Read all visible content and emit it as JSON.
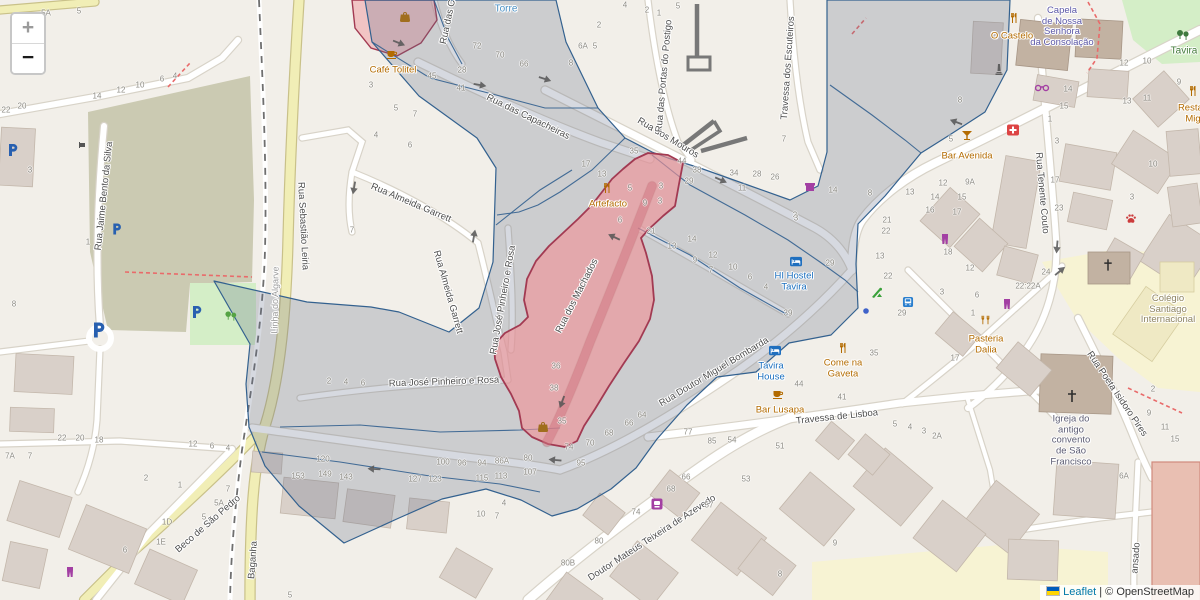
{
  "attribution": {
    "leaflet": "Leaflet",
    "separator": " | ",
    "osm": "© OpenStreetMap"
  },
  "controls": {
    "zoom_in": "+",
    "zoom_out": "−"
  },
  "colors": {
    "bg": "#f2efe9",
    "road": "#ffffff",
    "road_casing": "#d8d3c8",
    "yellow_road": "#f1eeb6",
    "yellow_casing": "#c9c189",
    "olive": "#cbcab2",
    "park": "#d4eec7",
    "school": "#f7f3d3",
    "building": "#d9d0c9",
    "building_stroke": "#c3b7ab",
    "building_dark": "#c2b2a2",
    "salmon": "#e9bfb2",
    "salmon_stroke": "#d08a7c",
    "overlay_stroke": "#33618f",
    "overlay_fill": "rgba(96,110,134,0.26)",
    "selected_stroke": "#a23a52",
    "selected_fill": "rgba(240,145,150,0.62)",
    "selected_road": "rgba(205,115,125,0.55)",
    "red_dash": "#e96a6a",
    "street_label": "#4e4e4e",
    "number": "#8f8d86",
    "poi_orange": "#b36b00",
    "poi_blue": "#1a6fbf",
    "poi_purple": "#5b57a7",
    "rail_dash": "#6f6f6f",
    "wall": "#787878",
    "attr_link": "#0078a8",
    "attr_text": "#333333"
  },
  "icon_colors": {
    "cafe": "#b36b00",
    "restaurant": "#b36b00",
    "restaurant2": "#b36b00",
    "bar": "#b36b00",
    "bag": "#a06e1e",
    "hostel": "#1f6fbf",
    "store": "#a33fa3",
    "clothes": "#a33fa3",
    "shop": "#a33fa3",
    "glasses": "#a33fa3",
    "busstop": "#2a7fce",
    "dot": "#3f62c9",
    "playground": "#3aa13a",
    "parking": "#2860b0",
    "firstaid": "#dd4444",
    "paw": "#cc3b3b",
    "worship": "#2d2d2d",
    "trees": "#3f7a3f",
    "trees2": "#55a344",
    "monument": "#606060",
    "barrier": "#555555"
  },
  "streets": [
    {
      "t": "Rua Jaime Bento da Silva",
      "x": 104,
      "y": 196,
      "r": -84
    },
    {
      "t": "Rua Sebastião Leiria",
      "x": 303,
      "y": 226,
      "r": 87
    },
    {
      "t": "Linha do Algarve",
      "x": 275,
      "y": 300,
      "r": -89,
      "c": "rail"
    },
    {
      "t": "Rua Almeida Garrett",
      "x": 411,
      "y": 203,
      "r": 23
    },
    {
      "t": "Rua Almeida Garrett",
      "x": 448,
      "y": 292,
      "r": 74
    },
    {
      "t": "Rua José Pinheiro e Rosa",
      "x": 503,
      "y": 300,
      "r": -80
    },
    {
      "t": "Rua José Pinheiro e Rosa",
      "x": 444,
      "y": 382,
      "r": -2
    },
    {
      "t": "Rua das Capacheiras",
      "x": 528,
      "y": 117,
      "r": 26
    },
    {
      "t": "Rua dos Mouros",
      "x": 668,
      "y": 138,
      "r": 31
    },
    {
      "t": "Rua das Portas do Postigo",
      "x": 664,
      "y": 76,
      "r": -85
    },
    {
      "t": "Travessa dos Escuteiros",
      "x": 788,
      "y": 68,
      "r": -86
    },
    {
      "t": "Rua das C",
      "x": 448,
      "y": 22,
      "r": -78
    },
    {
      "t": "Rua dos Machados",
      "x": 577,
      "y": 296,
      "r": -63
    },
    {
      "t": "Rua Doutor Miguel Bombarda",
      "x": 714,
      "y": 372,
      "r": -31
    },
    {
      "t": "Travessa de Lisboa",
      "x": 837,
      "y": 417,
      "r": -6
    },
    {
      "t": "Rua Tenente Couto",
      "x": 1042,
      "y": 193,
      "r": 85
    },
    {
      "t": "Rua Poeta Isidoro Pires",
      "x": 1117,
      "y": 394,
      "r": 56
    },
    {
      "t": "ansado",
      "x": 1136,
      "y": 558,
      "r": -86
    },
    {
      "t": "Beco de São Pedro",
      "x": 208,
      "y": 524,
      "r": -41
    },
    {
      "t": "Baganha",
      "x": 253,
      "y": 560,
      "r": -86
    },
    {
      "t": "Doutor Mateus Teixeira de Azevedo",
      "x": 652,
      "y": 538,
      "r": -33
    },
    {
      "t": "Torre",
      "x": 506,
      "y": 9,
      "r": 0,
      "c": "blue"
    },
    {
      "t": "Tavira",
      "x": 1184,
      "y": 51,
      "r": 0,
      "c": "green"
    }
  ],
  "pois": [
    {
      "t": "Café Tolitel",
      "x": 393,
      "y": 71,
      "c": "orange"
    },
    {
      "t": "Artefacto",
      "x": 608,
      "y": 205,
      "c": "orange"
    },
    {
      "t": "HI Hostel\nTavira",
      "x": 794,
      "y": 282,
      "c": "blue"
    },
    {
      "t": "Tavira\nHouse",
      "x": 771,
      "y": 372,
      "c": "blue"
    },
    {
      "t": "Bar Lusapa",
      "x": 780,
      "y": 411,
      "c": "orange"
    },
    {
      "t": "Come na\nGaveta",
      "x": 843,
      "y": 369,
      "c": "orange"
    },
    {
      "t": "Bar Avenida",
      "x": 967,
      "y": 157,
      "c": "orange"
    },
    {
      "t": "O Castelo",
      "x": 1012,
      "y": 37,
      "c": "orange"
    },
    {
      "t": "Capela\nde Nossa\nSenhora\nda Consolação",
      "x": 1062,
      "y": 27,
      "c": "purple"
    },
    {
      "t": "Pasteria\nDalia",
      "x": 986,
      "y": 345,
      "c": "orange"
    },
    {
      "t": "Restau\nMig",
      "x": 1193,
      "y": 114,
      "c": "orange"
    },
    {
      "t": "Colégio\nSantiago\nInternacional",
      "x": 1168,
      "y": 310,
      "c": "olive"
    },
    {
      "t": "Igreja do\nantigo\nconvento\nde São\nFrancisco",
      "x": 1071,
      "y": 441,
      "c": "dark"
    }
  ],
  "icons": [
    {
      "t": "cafe",
      "x": 392,
      "y": 54
    },
    {
      "t": "bag",
      "x": 405,
      "y": 17
    },
    {
      "t": "restaurant",
      "x": 607,
      "y": 188
    },
    {
      "t": "hostel",
      "x": 796,
      "y": 262
    },
    {
      "t": "hostel",
      "x": 775,
      "y": 351
    },
    {
      "t": "cafe",
      "x": 778,
      "y": 394
    },
    {
      "t": "restaurant",
      "x": 843,
      "y": 348
    },
    {
      "t": "bar",
      "x": 967,
      "y": 135
    },
    {
      "t": "restaurant",
      "x": 1014,
      "y": 18
    },
    {
      "t": "restaurant2",
      "x": 985,
      "y": 320
    },
    {
      "t": "restaurant",
      "x": 1193,
      "y": 91
    },
    {
      "t": "monument",
      "x": 999,
      "y": 69
    },
    {
      "t": "glasses",
      "x": 1042,
      "y": 88,
      "s": 15
    },
    {
      "t": "firstaid",
      "x": 1013,
      "y": 130
    },
    {
      "t": "paw",
      "x": 1131,
      "y": 219
    },
    {
      "t": "worship",
      "x": 1108,
      "y": 265,
      "s": 13
    },
    {
      "t": "worship",
      "x": 1072,
      "y": 396,
      "s": 14
    },
    {
      "t": "trees",
      "x": 1183,
      "y": 35,
      "s": 14
    },
    {
      "t": "trees2",
      "x": 231,
      "y": 316,
      "s": 13
    },
    {
      "t": "shop",
      "x": 810,
      "y": 187
    },
    {
      "t": "clothes",
      "x": 945,
      "y": 239
    },
    {
      "t": "clothes",
      "x": 1007,
      "y": 304
    },
    {
      "t": "clothes",
      "x": 70,
      "y": 572
    },
    {
      "t": "store",
      "x": 657,
      "y": 504
    },
    {
      "t": "busstop",
      "x": 908,
      "y": 302,
      "s": 11
    },
    {
      "t": "dot",
      "x": 866,
      "y": 311,
      "s": 7
    },
    {
      "t": "playground",
      "x": 877,
      "y": 293
    },
    {
      "t": "parking",
      "x": 13,
      "y": 150,
      "s": 12
    },
    {
      "t": "parking",
      "x": 117,
      "y": 229,
      "s": 11
    },
    {
      "t": "parking",
      "x": 99,
      "y": 330,
      "s": 15
    },
    {
      "t": "parking",
      "x": 197,
      "y": 312,
      "s": 12
    },
    {
      "t": "bag",
      "x": 543,
      "y": 427
    },
    {
      "t": "barrier",
      "x": 82,
      "y": 145,
      "s": 8
    }
  ],
  "arrows": [
    {
      "x": 399,
      "y": 43,
      "r": 22
    },
    {
      "x": 480,
      "y": 85,
      "r": 10
    },
    {
      "x": 545,
      "y": 79,
      "r": 18
    },
    {
      "x": 721,
      "y": 180,
      "r": 24
    },
    {
      "x": 956,
      "y": 122,
      "r": 200
    },
    {
      "x": 354,
      "y": 188,
      "r": 100
    },
    {
      "x": 474,
      "y": 236,
      "r": -80
    },
    {
      "x": 562,
      "y": 402,
      "r": 110
    },
    {
      "x": 374,
      "y": 469,
      "r": 183
    },
    {
      "x": 555,
      "y": 460,
      "r": 185
    },
    {
      "x": 1060,
      "y": 271,
      "r": -40
    },
    {
      "x": 1057,
      "y": 247,
      "r": 95
    },
    {
      "x": 614,
      "y": 237,
      "r": 205
    }
  ],
  "numbers": [
    {
      "t": "5A",
      "x": 46,
      "y": 13
    },
    {
      "t": "5",
      "x": 79,
      "y": 11
    },
    {
      "t": "22",
      "x": 6,
      "y": 110
    },
    {
      "t": "20",
      "x": 22,
      "y": 106
    },
    {
      "t": "14",
      "x": 97,
      "y": 96
    },
    {
      "t": "12",
      "x": 121,
      "y": 90
    },
    {
      "t": "10",
      "x": 140,
      "y": 85
    },
    {
      "t": "6",
      "x": 162,
      "y": 79
    },
    {
      "t": "4",
      "x": 175,
      "y": 76
    },
    {
      "t": "3",
      "x": 30,
      "y": 170
    },
    {
      "t": "1",
      "x": 88,
      "y": 242
    },
    {
      "t": "8",
      "x": 14,
      "y": 304
    },
    {
      "t": "7A",
      "x": 10,
      "y": 456
    },
    {
      "t": "7",
      "x": 30,
      "y": 456
    },
    {
      "t": "22",
      "x": 62,
      "y": 438
    },
    {
      "t": "20",
      "x": 80,
      "y": 438
    },
    {
      "t": "18",
      "x": 99,
      "y": 440
    },
    {
      "t": "12",
      "x": 193,
      "y": 444
    },
    {
      "t": "6",
      "x": 212,
      "y": 446
    },
    {
      "t": "4",
      "x": 228,
      "y": 448
    },
    {
      "t": "2",
      "x": 146,
      "y": 478
    },
    {
      "t": "1",
      "x": 180,
      "y": 485
    },
    {
      "t": "7",
      "x": 228,
      "y": 489
    },
    {
      "t": "5A",
      "x": 219,
      "y": 503
    },
    {
      "t": "5",
      "x": 204,
      "y": 517
    },
    {
      "t": "1D",
      "x": 167,
      "y": 522
    },
    {
      "t": "1E",
      "x": 161,
      "y": 542
    },
    {
      "t": "6",
      "x": 125,
      "y": 550
    },
    {
      "t": "5",
      "x": 290,
      "y": 595
    },
    {
      "t": "72",
      "x": 477,
      "y": 46
    },
    {
      "t": "70",
      "x": 500,
      "y": 55
    },
    {
      "t": "66",
      "x": 524,
      "y": 64
    },
    {
      "t": "45",
      "x": 432,
      "y": 76
    },
    {
      "t": "28",
      "x": 462,
      "y": 70
    },
    {
      "t": "41",
      "x": 461,
      "y": 88
    },
    {
      "t": "3",
      "x": 371,
      "y": 85
    },
    {
      "t": "5",
      "x": 396,
      "y": 108
    },
    {
      "t": "7",
      "x": 415,
      "y": 114
    },
    {
      "t": "4",
      "x": 376,
      "y": 135
    },
    {
      "t": "6",
      "x": 410,
      "y": 145
    },
    {
      "t": "7",
      "x": 352,
      "y": 230
    },
    {
      "t": "6A",
      "x": 583,
      "y": 46
    },
    {
      "t": "5",
      "x": 595,
      "y": 46
    },
    {
      "t": "8",
      "x": 571,
      "y": 63
    },
    {
      "t": "2",
      "x": 599,
      "y": 25
    },
    {
      "t": "4",
      "x": 625,
      "y": 5
    },
    {
      "t": "2",
      "x": 647,
      "y": 10
    },
    {
      "t": "1",
      "x": 659,
      "y": 13
    },
    {
      "t": "5",
      "x": 678,
      "y": 6
    },
    {
      "t": "35",
      "x": 634,
      "y": 151
    },
    {
      "t": "44",
      "x": 682,
      "y": 161
    },
    {
      "t": "7",
      "x": 784,
      "y": 139
    },
    {
      "t": "17",
      "x": 586,
      "y": 164
    },
    {
      "t": "13",
      "x": 602,
      "y": 174
    },
    {
      "t": "5",
      "x": 630,
      "y": 188
    },
    {
      "t": "3",
      "x": 661,
      "y": 186
    },
    {
      "t": "3",
      "x": 660,
      "y": 201
    },
    {
      "t": "9",
      "x": 645,
      "y": 203
    },
    {
      "t": "6",
      "x": 620,
      "y": 220
    },
    {
      "t": "21",
      "x": 651,
      "y": 231
    },
    {
      "t": "38",
      "x": 697,
      "y": 170
    },
    {
      "t": "29",
      "x": 689,
      "y": 181
    },
    {
      "t": "34",
      "x": 734,
      "y": 173
    },
    {
      "t": "28",
      "x": 757,
      "y": 174
    },
    {
      "t": "26",
      "x": 775,
      "y": 177
    },
    {
      "t": "11",
      "x": 742,
      "y": 188
    },
    {
      "t": "3",
      "x": 795,
      "y": 215
    },
    {
      "t": "14",
      "x": 692,
      "y": 239
    },
    {
      "t": "13",
      "x": 672,
      "y": 246
    },
    {
      "t": "12",
      "x": 713,
      "y": 255
    },
    {
      "t": "9",
      "x": 695,
      "y": 260
    },
    {
      "t": "10",
      "x": 733,
      "y": 267
    },
    {
      "t": "7",
      "x": 711,
      "y": 270
    },
    {
      "t": "6",
      "x": 750,
      "y": 277
    },
    {
      "t": "4",
      "x": 766,
      "y": 287
    },
    {
      "t": "36",
      "x": 556,
      "y": 366
    },
    {
      "t": "38",
      "x": 554,
      "y": 388
    },
    {
      "t": "35",
      "x": 562,
      "y": 421
    },
    {
      "t": "2",
      "x": 329,
      "y": 381
    },
    {
      "t": "4",
      "x": 346,
      "y": 382
    },
    {
      "t": "6",
      "x": 363,
      "y": 383
    },
    {
      "t": "64",
      "x": 642,
      "y": 415
    },
    {
      "t": "66",
      "x": 629,
      "y": 423
    },
    {
      "t": "68",
      "x": 609,
      "y": 433
    },
    {
      "t": "77",
      "x": 688,
      "y": 432
    },
    {
      "t": "85",
      "x": 712,
      "y": 441
    },
    {
      "t": "74",
      "x": 569,
      "y": 447
    },
    {
      "t": "70",
      "x": 590,
      "y": 443
    },
    {
      "t": "95",
      "x": 581,
      "y": 463
    },
    {
      "t": "120",
      "x": 323,
      "y": 459
    },
    {
      "t": "153",
      "x": 298,
      "y": 476
    },
    {
      "t": "149",
      "x": 325,
      "y": 474
    },
    {
      "t": "143",
      "x": 346,
      "y": 477
    },
    {
      "t": "127",
      "x": 415,
      "y": 479
    },
    {
      "t": "123",
      "x": 435,
      "y": 479
    },
    {
      "t": "100",
      "x": 443,
      "y": 462
    },
    {
      "t": "96",
      "x": 462,
      "y": 463
    },
    {
      "t": "94",
      "x": 482,
      "y": 463
    },
    {
      "t": "86A",
      "x": 502,
      "y": 461
    },
    {
      "t": "115",
      "x": 482,
      "y": 478
    },
    {
      "t": "113",
      "x": 501,
      "y": 476
    },
    {
      "t": "80",
      "x": 528,
      "y": 458
    },
    {
      "t": "107",
      "x": 530,
      "y": 472
    },
    {
      "t": "10",
      "x": 481,
      "y": 514
    },
    {
      "t": "4",
      "x": 504,
      "y": 503
    },
    {
      "t": "7",
      "x": 497,
      "y": 516
    },
    {
      "t": "14",
      "x": 833,
      "y": 190
    },
    {
      "t": "8",
      "x": 870,
      "y": 193
    },
    {
      "t": "13",
      "x": 910,
      "y": 192
    },
    {
      "t": "3",
      "x": 796,
      "y": 218
    },
    {
      "t": "21",
      "x": 887,
      "y": 220
    },
    {
      "t": "22",
      "x": 886,
      "y": 231
    },
    {
      "t": "29",
      "x": 830,
      "y": 263
    },
    {
      "t": "13",
      "x": 880,
      "y": 256
    },
    {
      "t": "22",
      "x": 888,
      "y": 276
    },
    {
      "t": "39",
      "x": 788,
      "y": 313
    },
    {
      "t": "29",
      "x": 902,
      "y": 313
    },
    {
      "t": "12",
      "x": 943,
      "y": 183
    },
    {
      "t": "9A",
      "x": 970,
      "y": 182
    },
    {
      "t": "14",
      "x": 935,
      "y": 197
    },
    {
      "t": "15",
      "x": 962,
      "y": 197
    },
    {
      "t": "16",
      "x": 930,
      "y": 210
    },
    {
      "t": "17",
      "x": 957,
      "y": 212
    },
    {
      "t": "18",
      "x": 948,
      "y": 252
    },
    {
      "t": "12",
      "x": 970,
      "y": 268
    },
    {
      "t": "3",
      "x": 942,
      "y": 292
    },
    {
      "t": "6",
      "x": 977,
      "y": 295
    },
    {
      "t": "1",
      "x": 973,
      "y": 313
    },
    {
      "t": "5",
      "x": 951,
      "y": 139
    },
    {
      "t": "8",
      "x": 960,
      "y": 100
    },
    {
      "t": "12",
      "x": 1124,
      "y": 63
    },
    {
      "t": "10",
      "x": 1147,
      "y": 61
    },
    {
      "t": "14",
      "x": 1068,
      "y": 89
    },
    {
      "t": "15",
      "x": 1064,
      "y": 106
    },
    {
      "t": "1",
      "x": 1050,
      "y": 119
    },
    {
      "t": "13",
      "x": 1127,
      "y": 101
    },
    {
      "t": "11",
      "x": 1147,
      "y": 98
    },
    {
      "t": "9",
      "x": 1179,
      "y": 82
    },
    {
      "t": "3",
      "x": 1057,
      "y": 141
    },
    {
      "t": "17",
      "x": 1055,
      "y": 180
    },
    {
      "t": "23",
      "x": 1059,
      "y": 208
    },
    {
      "t": "10",
      "x": 1153,
      "y": 164
    },
    {
      "t": "3",
      "x": 1132,
      "y": 197
    },
    {
      "t": "24",
      "x": 1046,
      "y": 272
    },
    {
      "t": "22:22A",
      "x": 1028,
      "y": 286
    },
    {
      "t": "17",
      "x": 955,
      "y": 358
    },
    {
      "t": "2",
      "x": 1153,
      "y": 389
    },
    {
      "t": "35",
      "x": 874,
      "y": 353
    },
    {
      "t": "44",
      "x": 799,
      "y": 384
    },
    {
      "t": "41",
      "x": 842,
      "y": 397
    },
    {
      "t": "54",
      "x": 732,
      "y": 440
    },
    {
      "t": "51",
      "x": 780,
      "y": 446
    },
    {
      "t": "5",
      "x": 895,
      "y": 424
    },
    {
      "t": "4",
      "x": 910,
      "y": 427
    },
    {
      "t": "3",
      "x": 924,
      "y": 431
    },
    {
      "t": "2A",
      "x": 937,
      "y": 436
    },
    {
      "t": "66",
      "x": 686,
      "y": 477
    },
    {
      "t": "68",
      "x": 671,
      "y": 489
    },
    {
      "t": "74",
      "x": 636,
      "y": 512
    },
    {
      "t": "80",
      "x": 599,
      "y": 541
    },
    {
      "t": "80B",
      "x": 568,
      "y": 563
    },
    {
      "t": "53",
      "x": 746,
      "y": 479
    },
    {
      "t": "57",
      "x": 709,
      "y": 505
    },
    {
      "t": "8",
      "x": 780,
      "y": 574
    },
    {
      "t": "9",
      "x": 835,
      "y": 543
    },
    {
      "t": "9",
      "x": 1149,
      "y": 413
    },
    {
      "t": "11",
      "x": 1165,
      "y": 427
    },
    {
      "t": "15",
      "x": 1175,
      "y": 439
    },
    {
      "t": "6A",
      "x": 1124,
      "y": 476
    }
  ]
}
